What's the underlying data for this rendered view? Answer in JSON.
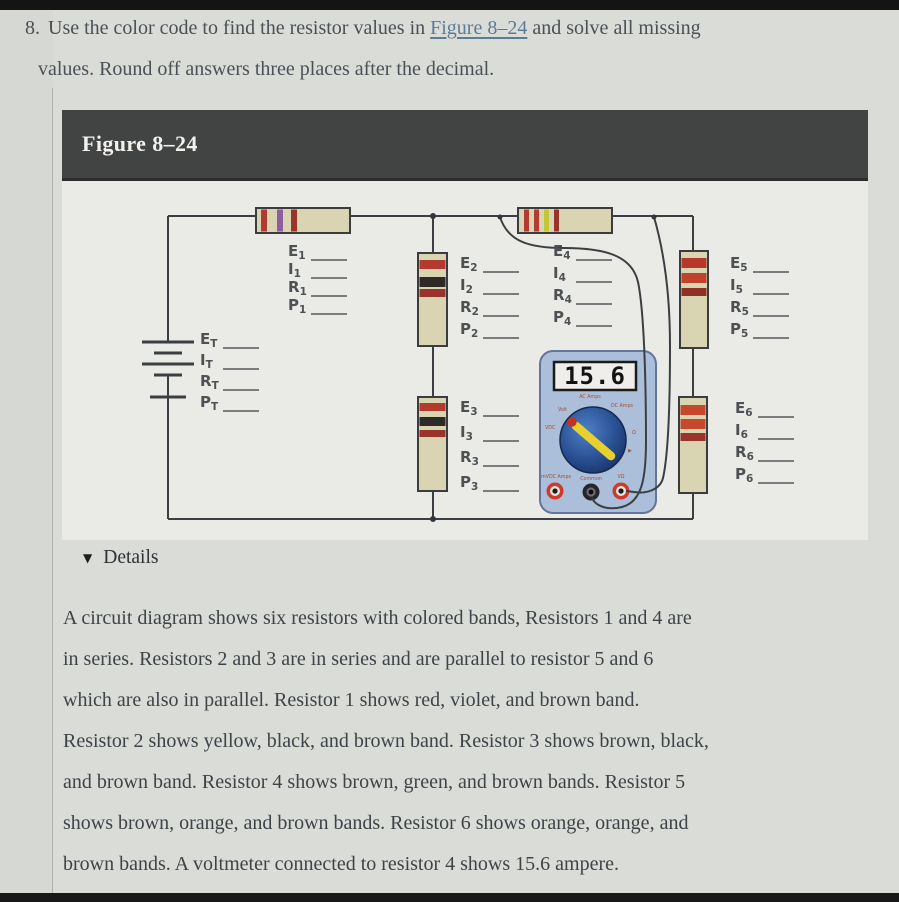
{
  "question": {
    "number": "8.",
    "pre_link": "Use the color code to find the resistor values in",
    "link": "Figure 8–24",
    "post_link": "and solve all missing",
    "line2": "values. Round off answers three places after the decimal."
  },
  "figure": {
    "title": "Figure 8–24",
    "label_groups": [
      {
        "name": "total",
        "rows": [
          [
            "E",
            "T"
          ],
          [
            "I",
            "T"
          ],
          [
            "R",
            "T"
          ],
          [
            "P",
            "T"
          ]
        ]
      },
      {
        "name": "r1",
        "rows": [
          [
            "E",
            "1"
          ],
          [
            "I",
            "1"
          ],
          [
            "R",
            "1"
          ],
          [
            "P",
            "1"
          ]
        ]
      },
      {
        "name": "r2",
        "rows": [
          [
            "E",
            "2"
          ],
          [
            "I",
            "2"
          ],
          [
            "R",
            "2"
          ],
          [
            "P",
            "2"
          ]
        ]
      },
      {
        "name": "r3",
        "rows": [
          [
            "E",
            "3"
          ],
          [
            "I",
            "3"
          ],
          [
            "R",
            "3"
          ],
          [
            "P",
            "3"
          ]
        ]
      },
      {
        "name": "r4",
        "rows": [
          [
            "E",
            "4"
          ],
          [
            "I",
            "4"
          ],
          [
            "R",
            "4"
          ],
          [
            "P",
            "4"
          ]
        ]
      },
      {
        "name": "r5",
        "rows": [
          [
            "E",
            "5"
          ],
          [
            "I",
            "5"
          ],
          [
            "R",
            "5"
          ],
          [
            "P",
            "5"
          ]
        ]
      },
      {
        "name": "r6",
        "rows": [
          [
            "E",
            "6"
          ],
          [
            "I",
            "6"
          ],
          [
            "R",
            "6"
          ],
          [
            "P",
            "6"
          ]
        ]
      }
    ],
    "resistors": [
      {
        "id": "1",
        "bands": "red, violet, brown",
        "band_colors": [
          "#b23a2e",
          "#8e5f9e",
          "#9a342a"
        ]
      },
      {
        "id": "2",
        "bands": "yellow, black, brown",
        "band_colors": [
          "#b23a2e",
          "#2d2a27",
          "#9a342a"
        ]
      },
      {
        "id": "3",
        "bands": "brown, black, brown",
        "band_colors": [
          "#b23a2e",
          "#2d2a27",
          "#9a342a"
        ]
      },
      {
        "id": "4",
        "bands": "brown, green, brown",
        "band_colors": [
          "#b23a2e",
          "#b23a2e",
          "#c3c636",
          "#9a342a"
        ]
      },
      {
        "id": "5",
        "bands": "brown, orange, brown",
        "band_colors": [
          "#b8372b",
          "#c0422d",
          "#8f2f26"
        ]
      },
      {
        "id": "6",
        "bands": "orange, orange, brown",
        "band_colors": [
          "#c6492e",
          "#c6492e",
          "#9a342a"
        ]
      }
    ],
    "meter": {
      "display": "15.6",
      "labels": [
        "Volt",
        "AC Amps",
        "DC Amps",
        "VDC",
        "Ω",
        "▶",
        "mVDC Amps",
        "Common",
        "VΩ"
      ]
    },
    "colors": {
      "wire": "#3c3f42",
      "resistor_body": "#d9d5b2",
      "meter_body": "#abbeda",
      "dial_blue": "#2a4f93",
      "pointer_yellow": "#e7cf2e",
      "pointer_tip_red": "#c73021"
    }
  },
  "details": {
    "icon": "▼",
    "label": "Details"
  },
  "description": {
    "lines": [
      "A circuit diagram shows six resistors with colored bands, Resistors 1 and 4 are",
      "in series. Resistors 2 and 3 are in series and are parallel to resistor 5 and 6",
      "which are also in parallel. Resistor 1 shows red, violet, and brown band.",
      "Resistor 2 shows yellow, black, and brown band. Resistor 3 shows brown, black,",
      "and brown band. Resistor 4 shows brown, green, and brown bands. Resistor 5",
      "shows brown, orange, and brown bands. Resistor 6 shows orange, orange, and",
      "brown bands. A voltmeter connected to resistor 4 shows 15.6 ampere."
    ]
  }
}
